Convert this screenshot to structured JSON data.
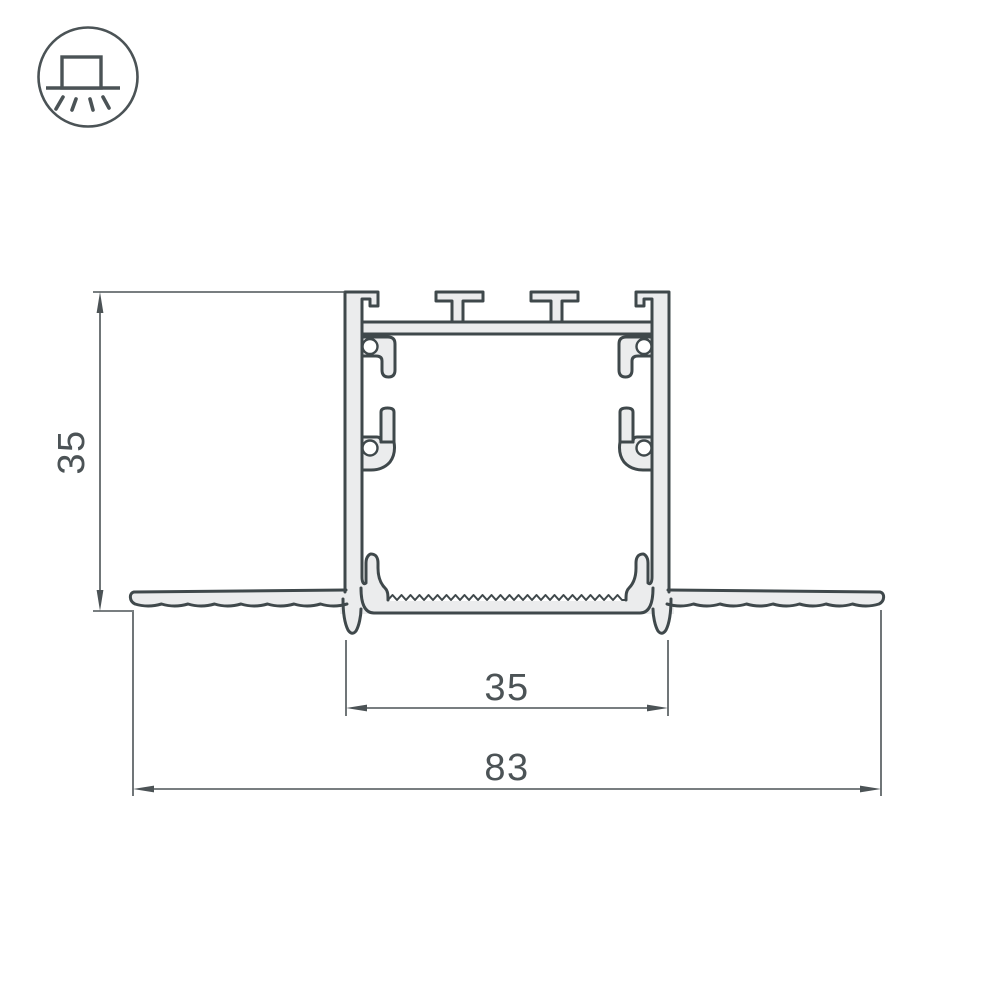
{
  "page": {
    "background": "#ffffff"
  },
  "icon": {
    "name": "recessed-light-icon",
    "meaning": "recessed mount luminaire symbol"
  },
  "drawing": {
    "type": "technical-cross-section",
    "subject": "Recessed aluminium LED profile cross-section with plaster-in wings",
    "dimensions": [
      {
        "id": "height",
        "label": "35",
        "orientation": "vertical"
      },
      {
        "id": "inner_width",
        "label": "35",
        "orientation": "horizontal"
      },
      {
        "id": "overall_width",
        "label": "83",
        "orientation": "horizontal"
      }
    ],
    "colors": {
      "outline": "#3f484b",
      "material_fill": "#ebeced",
      "hatch": "#969ea1",
      "dimension": "#4c5356",
      "background": "#ffffff"
    }
  }
}
